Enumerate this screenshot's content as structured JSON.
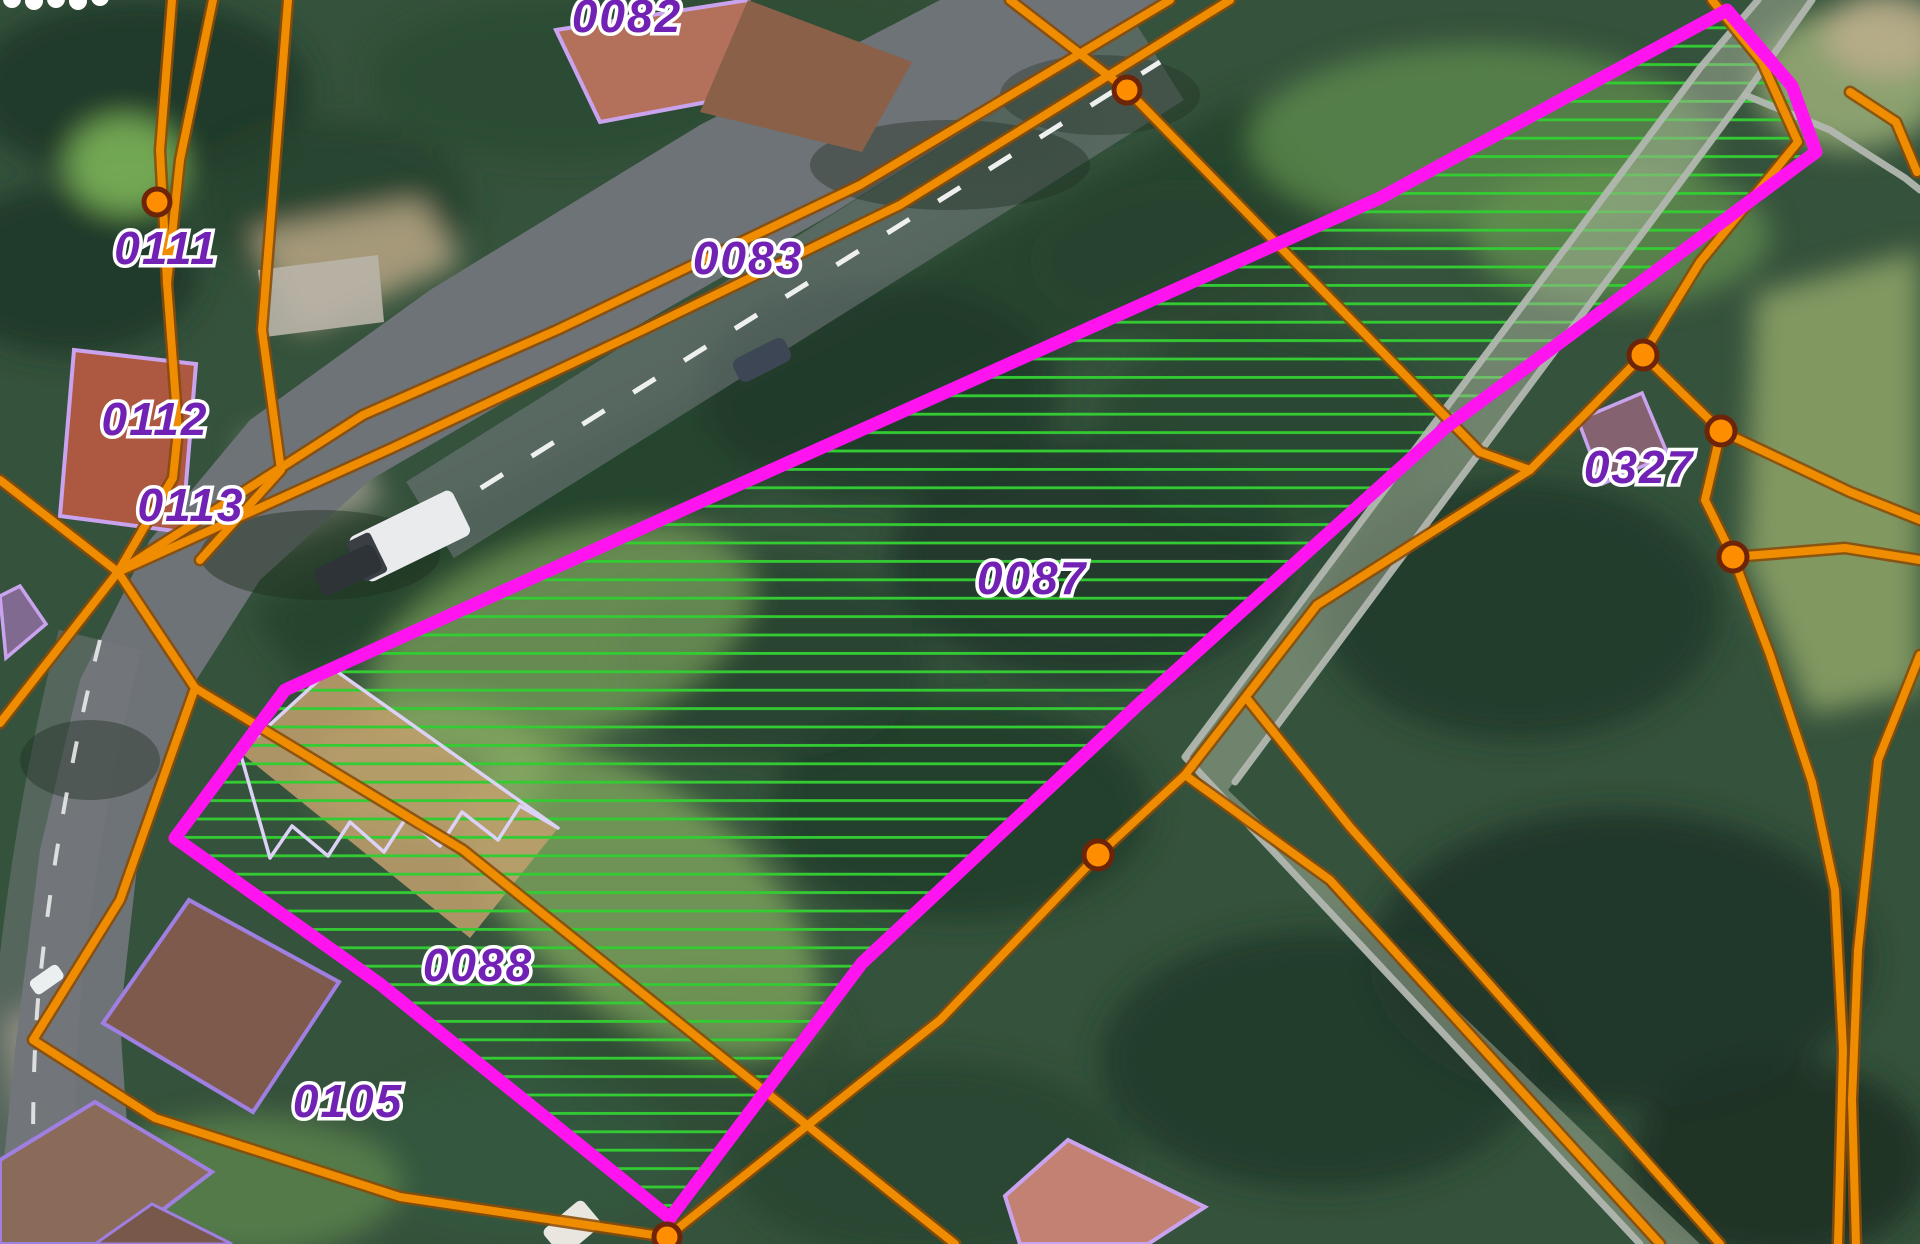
{
  "map": {
    "description": "Cadastral parcel overlay on aerial photo with one highlighted parcel group",
    "labels": [
      {
        "text": "0082"
      },
      {
        "text": "0083"
      },
      {
        "text": "0111"
      },
      {
        "text": "0112"
      },
      {
        "text": "0113"
      },
      {
        "text": "0087"
      },
      {
        "text": "0088"
      },
      {
        "text": "0105"
      },
      {
        "text": "0327"
      }
    ],
    "highlighted_parcels": [
      "0087",
      "0088"
    ],
    "vertex_dot_count": 7,
    "colors": {
      "parcel_boundary": "#f08c00",
      "highlight_outline": "#ff14f0",
      "highlight_hatch": "#33cc33",
      "building_outline": "#caa3ef",
      "label_text": "#7122b4",
      "track_line": "#b2b7b0"
    }
  }
}
